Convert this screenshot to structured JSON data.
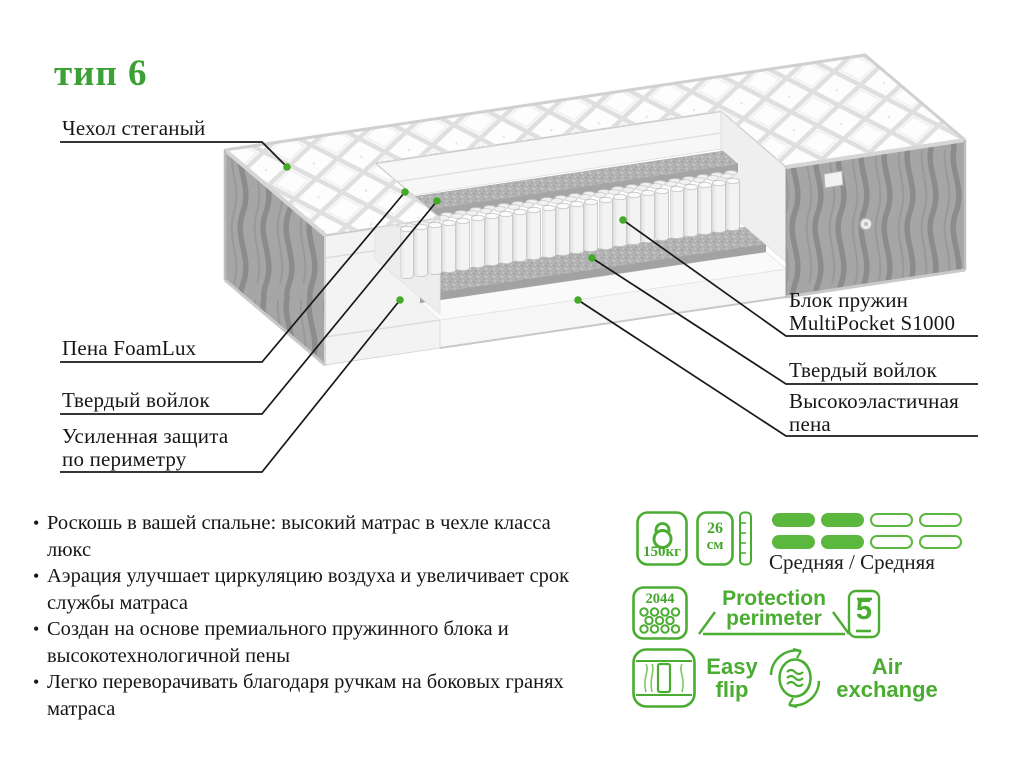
{
  "title": "тип 6",
  "callouts": {
    "left": [
      {
        "lines": [
          "Чехол стеганый"
        ]
      },
      {
        "lines": [
          "Пена FoamLux"
        ]
      },
      {
        "lines": [
          "Твердый войлок"
        ]
      },
      {
        "lines": [
          "Усиленная защита",
          "по периметру"
        ]
      }
    ],
    "right": [
      {
        "lines": [
          "Блок пружин",
          "MultiPocket S1000"
        ]
      },
      {
        "lines": [
          "Твердый войлок"
        ]
      },
      {
        "lines": [
          "Высокоэластичная",
          "пена"
        ]
      }
    ]
  },
  "features": [
    "Роскошь в вашей спальне: высокий матрас в чехле класса люкс",
    "Аэрация улучшает циркуляцию воздуха и увеличивает срок службы матраса",
    "Создан на основе премиального пружинного блока и высокотехнологичной пены",
    "Легко переворачивать благодаря ручкам на боковых гранях матраса"
  ],
  "specs": {
    "max_weight": "150кг",
    "height_value": "26",
    "height_unit": "см",
    "firmness": "Средняя / Средняя",
    "springs_count": "2044",
    "protection": {
      "line1": "Protection",
      "line2": "perimeter"
    },
    "warranty_years": "5",
    "easy_flip": {
      "line1": "Easy",
      "line2": "flip"
    },
    "air_exchange": {
      "line1": "Air",
      "line2": "exchange"
    }
  },
  "colors": {
    "accent_green": "#4aad31",
    "firmness_fill": "#5bb73e",
    "title_green": "#3ba135",
    "dot_green": "#43aa28"
  }
}
